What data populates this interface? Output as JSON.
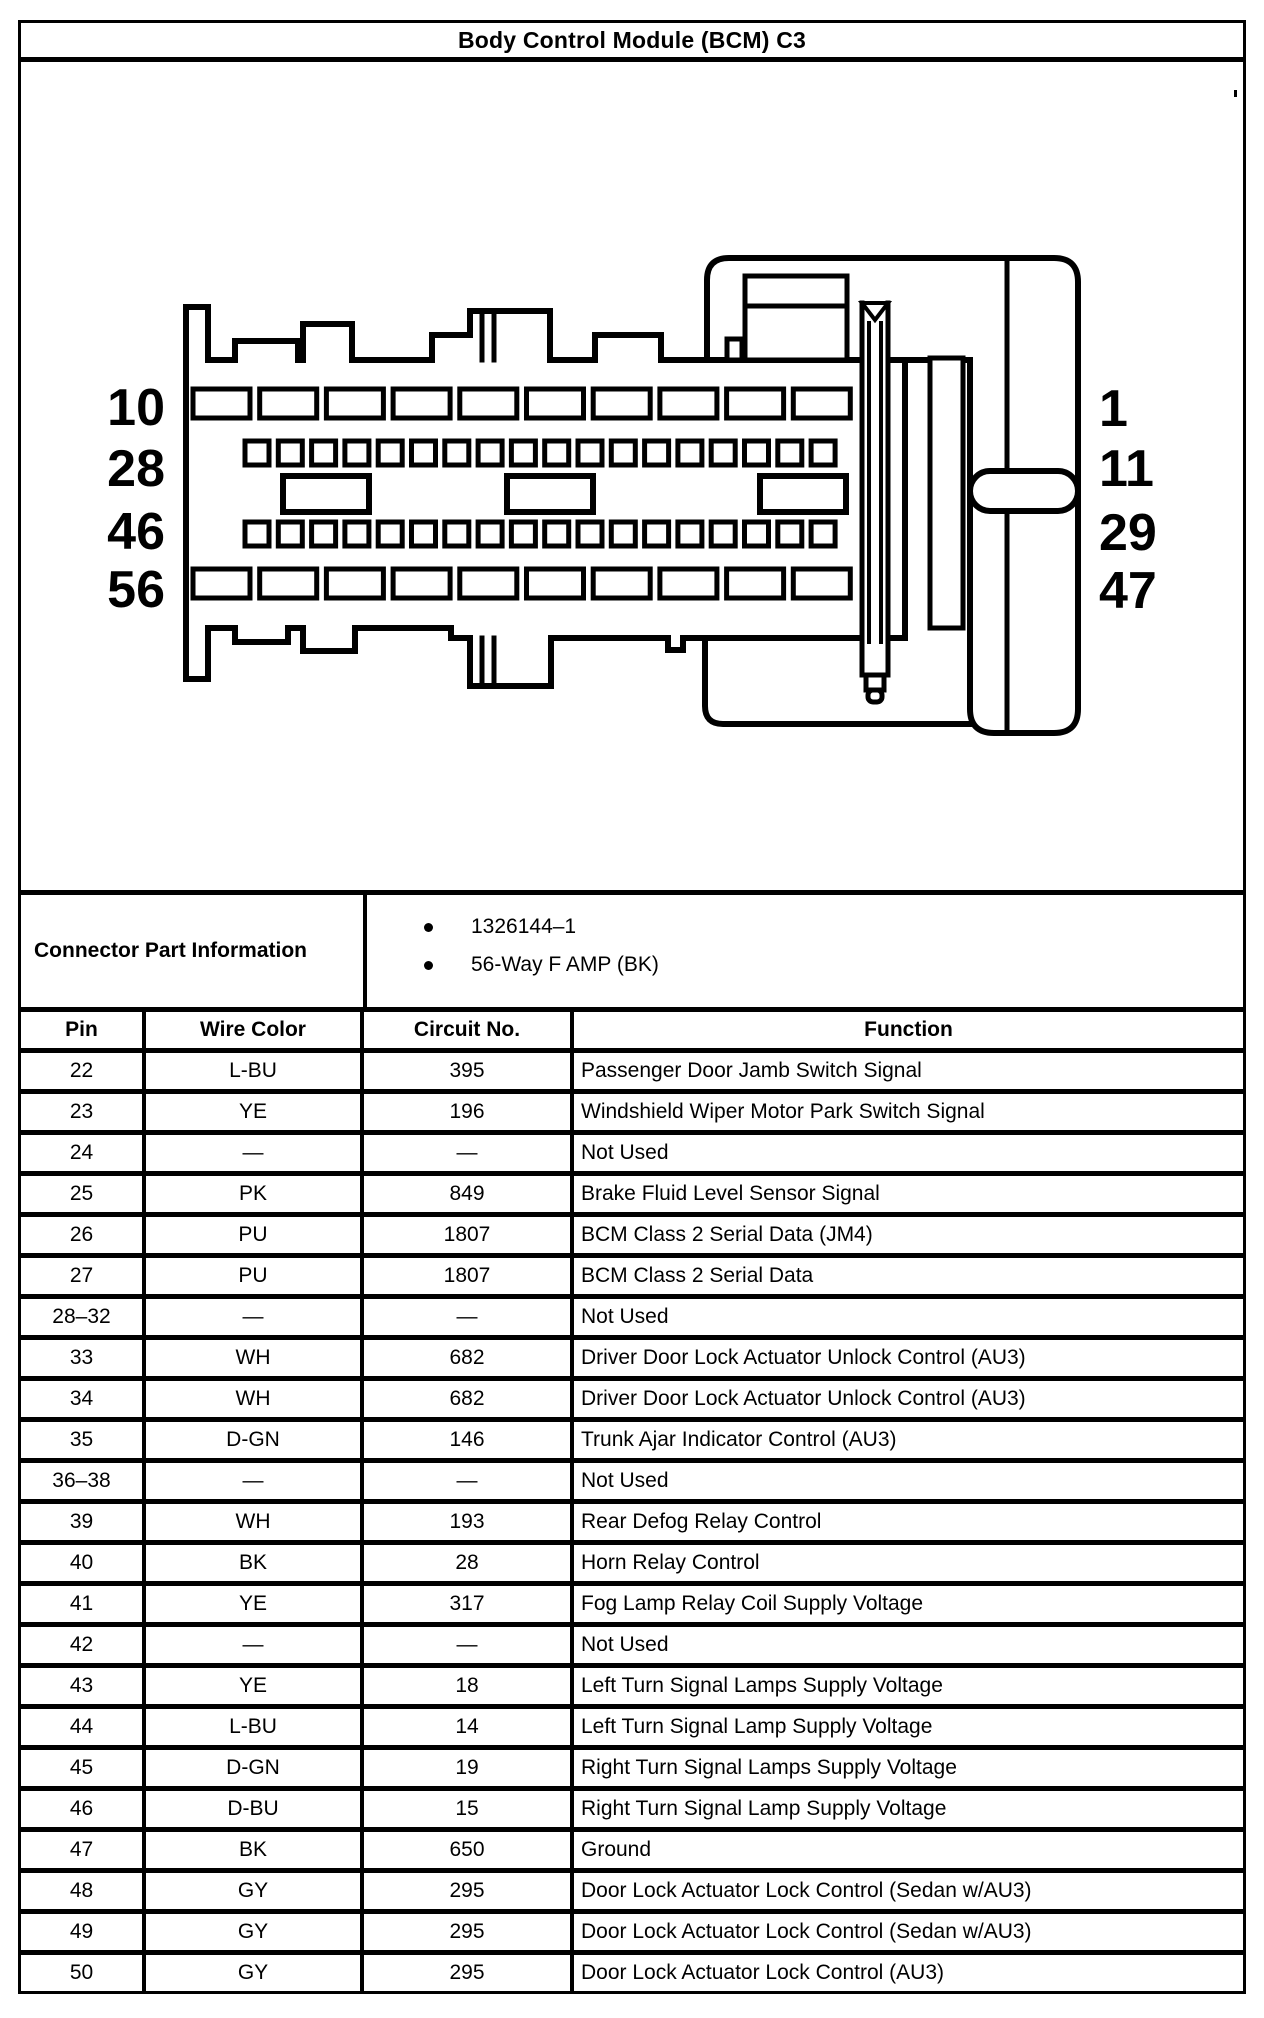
{
  "title": "Body Control Module (BCM) C3",
  "connector": {
    "left_pins": [
      "10",
      "28",
      "46",
      "56"
    ],
    "right_pins": [
      "1",
      "11",
      "29",
      "47"
    ]
  },
  "part_info": {
    "label": "Connector Part Information",
    "bullets": [
      "1326144–1",
      "56-Way F AMP (BK)"
    ]
  },
  "table": {
    "headers": [
      "Pin",
      "Wire Color",
      "Circuit No.",
      "Function"
    ],
    "rows": [
      [
        "22",
        "L-BU",
        "395",
        "Passenger Door Jamb Switch Signal"
      ],
      [
        "23",
        "YE",
        "196",
        "Windshield Wiper Motor Park Switch Signal"
      ],
      [
        "24",
        "—",
        "—",
        "Not Used"
      ],
      [
        "25",
        "PK",
        "849",
        "Brake Fluid Level Sensor Signal"
      ],
      [
        "26",
        "PU",
        "1807",
        "BCM Class 2 Serial Data (JM4)"
      ],
      [
        "27",
        "PU",
        "1807",
        "BCM Class 2 Serial Data"
      ],
      [
        "28–32",
        "—",
        "—",
        "Not Used"
      ],
      [
        "33",
        "WH",
        "682",
        "Driver Door Lock Actuator Unlock Control (AU3)"
      ],
      [
        "34",
        "WH",
        "682",
        "Driver Door Lock Actuator Unlock Control (AU3)"
      ],
      [
        "35",
        "D-GN",
        "146",
        "Trunk Ajar Indicator Control (AU3)"
      ],
      [
        "36–38",
        "—",
        "—",
        "Not Used"
      ],
      [
        "39",
        "WH",
        "193",
        "Rear Defog Relay Control"
      ],
      [
        "40",
        "BK",
        "28",
        "Horn Relay Control"
      ],
      [
        "41",
        "YE",
        "317",
        "Fog Lamp Relay Coil Supply Voltage"
      ],
      [
        "42",
        "—",
        "—",
        "Not Used"
      ],
      [
        "43",
        "YE",
        "18",
        "Left Turn Signal Lamps Supply Voltage"
      ],
      [
        "44",
        "L-BU",
        "14",
        "Left Turn Signal Lamp Supply Voltage"
      ],
      [
        "45",
        "D-GN",
        "19",
        "Right Turn Signal Lamps Supply Voltage"
      ],
      [
        "46",
        "D-BU",
        "15",
        "Right Turn Signal Lamp Supply Voltage"
      ],
      [
        "47",
        "BK",
        "650",
        "Ground"
      ],
      [
        "48",
        "GY",
        "295",
        "Door Lock Actuator Lock Control (Sedan w/AU3)"
      ],
      [
        "49",
        "GY",
        "295",
        "Door Lock Actuator Lock Control (Sedan w/AU3)"
      ],
      [
        "50",
        "GY",
        "295",
        "Door Lock Actuator Lock Control (AU3)"
      ]
    ]
  },
  "colors": {
    "ink": "#000000",
    "paper": "#ffffff"
  }
}
